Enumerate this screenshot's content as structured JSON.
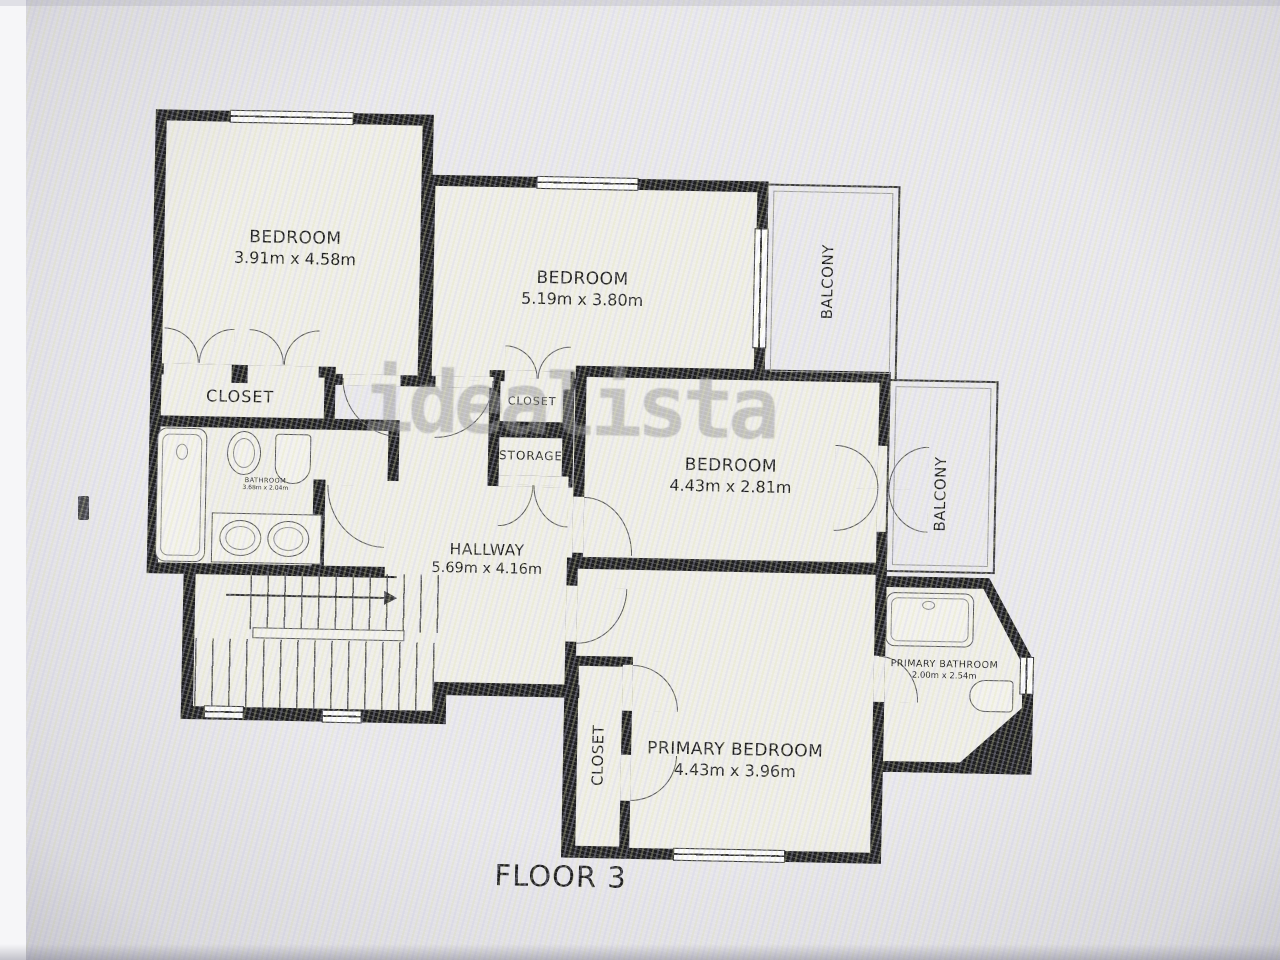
{
  "floor_label": "FLOOR 3",
  "watermark": "idealista",
  "colors": {
    "wall": "#1d1d1f",
    "room_fill": "#efeee8",
    "background": "#e9e8ec",
    "thin_line": "#555555",
    "watermark": "#8e8e8e",
    "text": "#1c1c1c"
  },
  "rooms": {
    "bedroom_top_left": {
      "name": "BEDROOM",
      "dims": "3.91m x 4.58m"
    },
    "bedroom_top_middle": {
      "name": "BEDROOM",
      "dims": "5.19m x 3.80m"
    },
    "bedroom_middle_right": {
      "name": "BEDROOM",
      "dims": "4.43m x 2.81m"
    },
    "primary_bedroom": {
      "name": "PRIMARY BEDROOM",
      "dims": "4.43m x 3.96m"
    },
    "hallway": {
      "name": "HALLWAY",
      "dims": "5.69m x 4.16m"
    },
    "bathroom": {
      "name": "BATHROOM",
      "dims": "3.68m x 2.04m"
    },
    "primary_bathroom": {
      "name": "PRIMARY BATHROOM",
      "dims": "2.00m x 2.54m"
    },
    "closet_top_left": {
      "name": "CLOSET"
    },
    "closet_middle": {
      "name": "CLOSET"
    },
    "storage": {
      "name": "STORAGE"
    },
    "closet_primary": {
      "name": "CLOSET"
    },
    "balcony_top": {
      "name": "BALCONY"
    },
    "balcony_right": {
      "name": "BALCONY"
    }
  }
}
